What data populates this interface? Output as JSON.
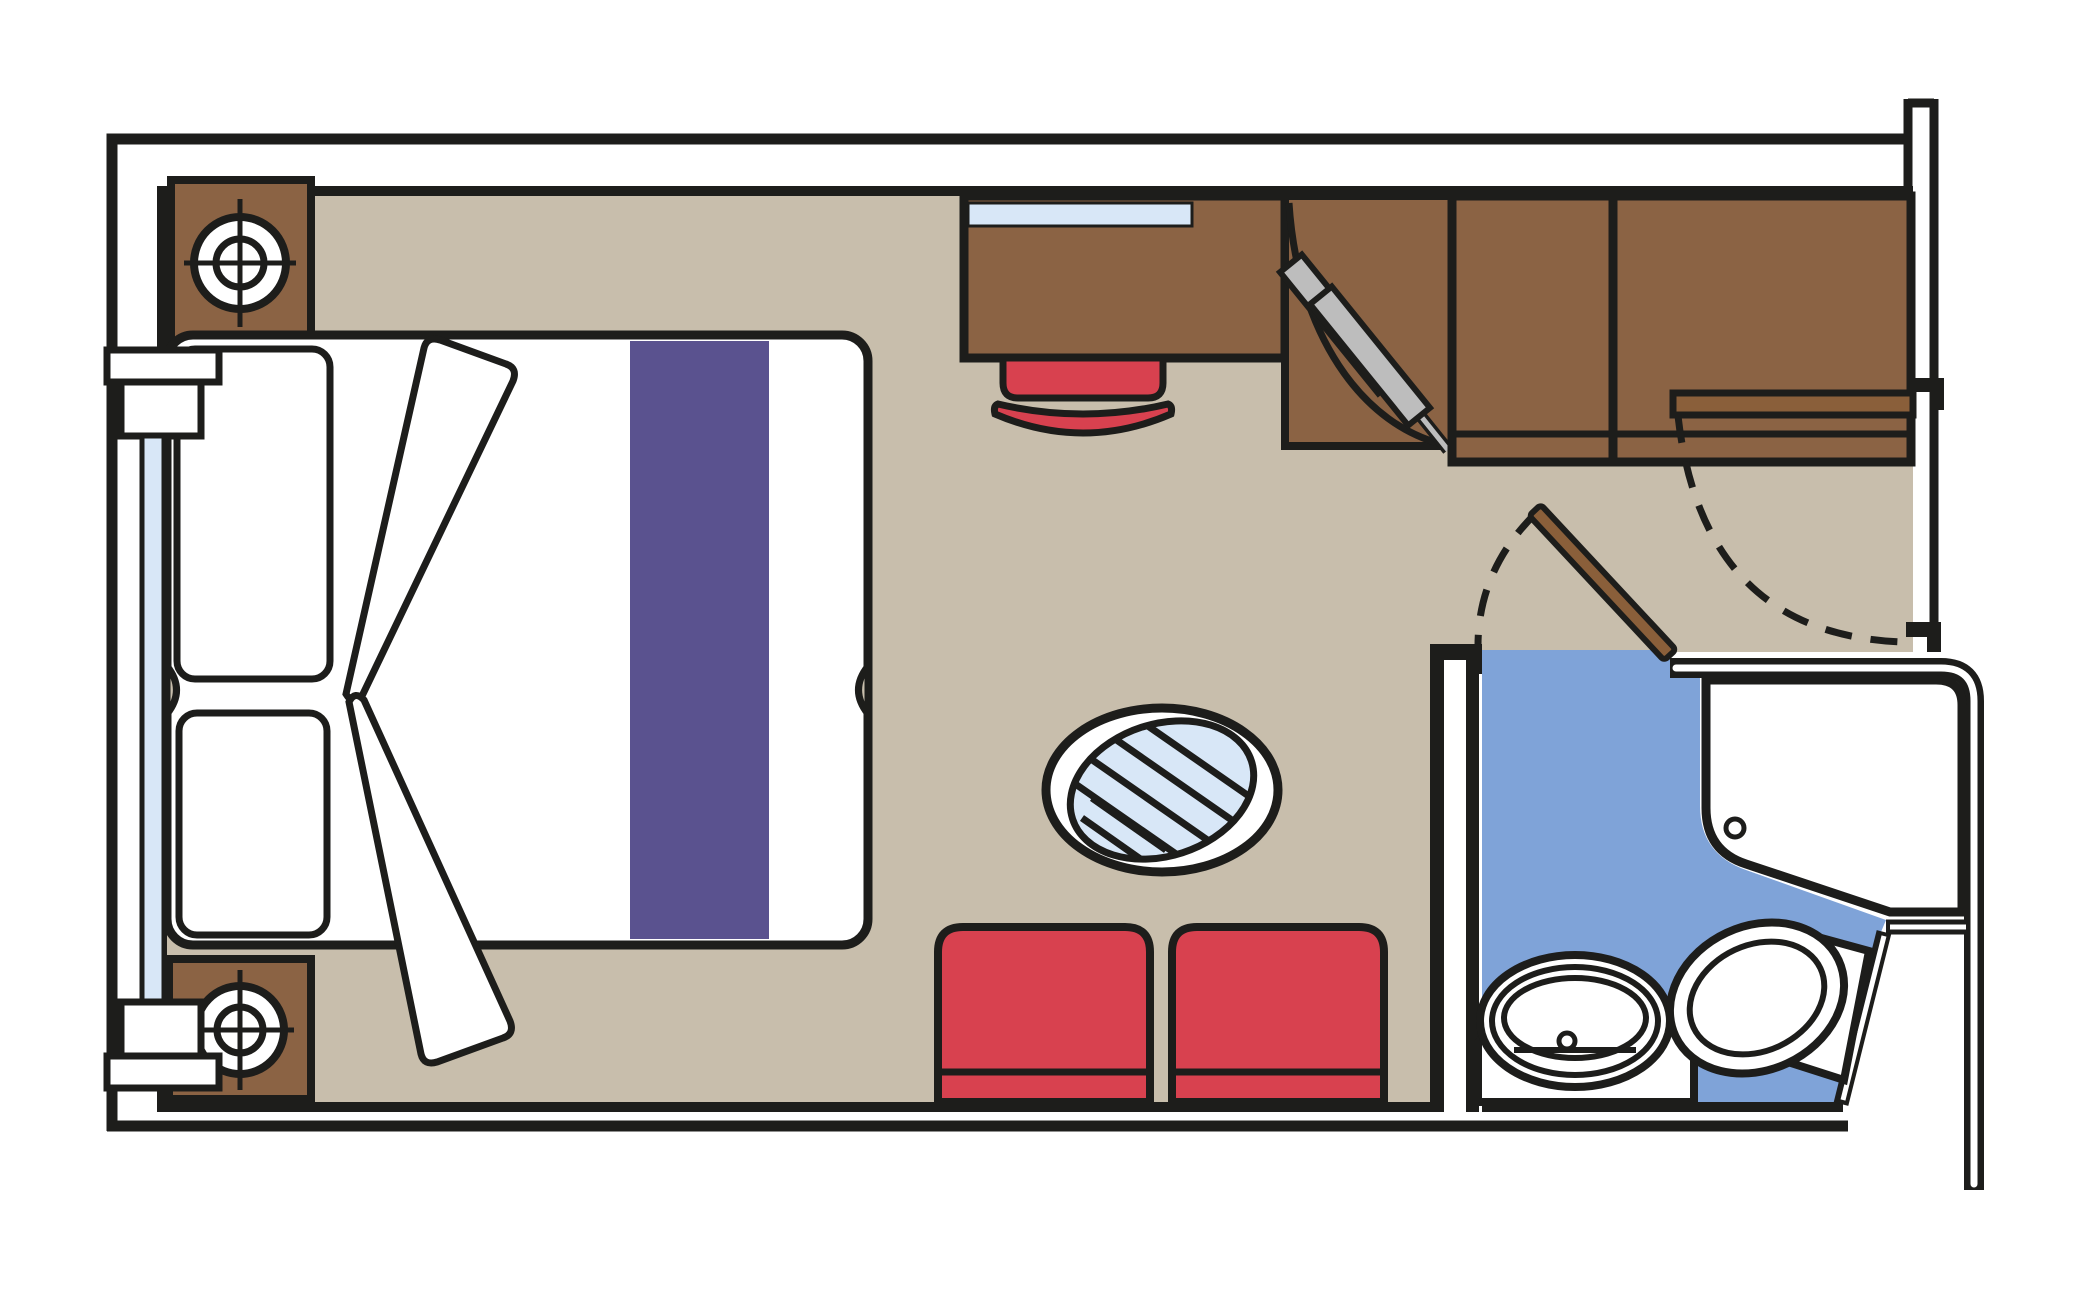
{
  "colors": {
    "line": "#1d1d1b",
    "white": "#ffffff",
    "floor_tan": "#c8beac",
    "wood_brown": "#8b6344",
    "door_brown": "#8a5f3a",
    "seat_red": "#d8414f",
    "bath_blue": "#7fa3d8",
    "glass_blue": "#d8e7f7",
    "runner_purple": "#5a528f",
    "hanger_gray": "#bdbdbd"
  },
  "plan": {
    "kind": "cabin-floor-plan",
    "objects": [
      "exterior-walls",
      "corridor-wall",
      "picture-window",
      "nightstand-top",
      "nightstand-bottom",
      "table-lamp",
      "table-lamp",
      "double-bed",
      "pillow",
      "pillow",
      "bed-runner",
      "folded-blanket",
      "desk",
      "desk-shelf",
      "stool",
      "wardrobe-open-door",
      "clothes-hangers",
      "wardrobe-doors",
      "entry-door",
      "entry-door-swing",
      "bathroom",
      "bathroom-door",
      "bathroom-door-swing",
      "shower",
      "shower-drain",
      "washbasin",
      "faucet",
      "toilet",
      "toilet-tank",
      "glass-table",
      "seat-left",
      "seat-right"
    ]
  }
}
